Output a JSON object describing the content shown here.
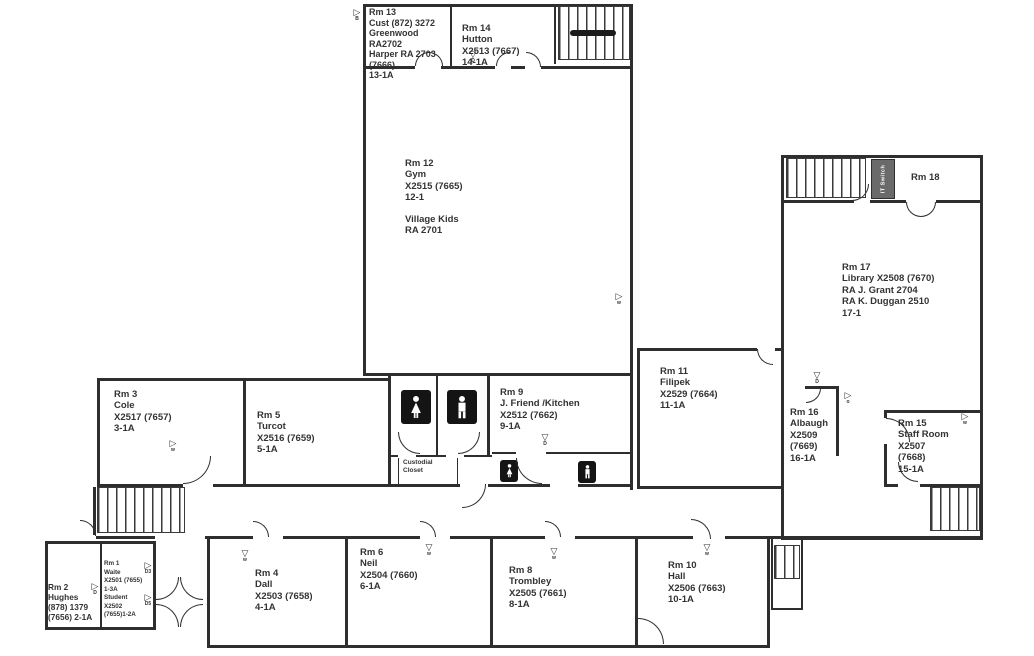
{
  "rooms": {
    "rm13": {
      "lines": [
        "Rm 13",
        "Cust (872) 3272",
        "Greenwood",
        "RA2702",
        "Harper RA 2703",
        "(7666)",
        "13-1A"
      ]
    },
    "rm14": {
      "lines": [
        "Rm 14",
        "Hutton",
        "X2513 (7667)",
        "14-1A"
      ]
    },
    "rm12": {
      "lines": [
        "Rm 12",
        "Gym",
        "X2515 (7665)",
        "12-1",
        "",
        "Village Kids",
        "RA 2701"
      ]
    },
    "rm18": {
      "lines": [
        "Rm 18"
      ]
    },
    "rm17": {
      "lines": [
        "Rm 17",
        "Library X2508 (7670)",
        "RA J. Grant 2704",
        "RA K. Duggan 2510",
        "17-1"
      ]
    },
    "rm11": {
      "lines": [
        "Rm 11",
        "Filipek",
        "X2529 (7664)",
        "11-1A"
      ]
    },
    "rm16": {
      "lines": [
        "Rm 16",
        "Albaugh",
        "X2509",
        "(7669)",
        "16-1A"
      ]
    },
    "rm15": {
      "lines": [
        "Rm 15",
        "Staff Room",
        "X2507",
        "(7668)",
        "15-1A"
      ]
    },
    "rm3": {
      "lines": [
        "Rm 3",
        "Cole",
        "X2517 (7657)",
        "3-1A"
      ]
    },
    "rm5": {
      "lines": [
        "Rm 5",
        "Turcot",
        "X2516 (7659)",
        "5-1A"
      ]
    },
    "rm9": {
      "lines": [
        "Rm 9",
        "J. Friend /Kitchen",
        "X2512 (7662)",
        "9-1A"
      ]
    },
    "rm2": {
      "lines": [
        "Rm 2",
        "Hughes",
        "(878) 1379",
        "(7656) 2-1A"
      ]
    },
    "rm1": {
      "lines": [
        "Rm 1",
        "Waite",
        "X2501 (7655)",
        "1-3A",
        "Student",
        "X2502",
        "(7655)1-2A"
      ]
    },
    "rm4": {
      "lines": [
        "Rm 4",
        "Dall",
        "X2503 (7658)",
        "4-1A"
      ]
    },
    "rm6": {
      "lines": [
        "Rm 6",
        "Neil",
        "X2504 (7660)",
        "6-1A"
      ]
    },
    "rm8": {
      "lines": [
        "Rm 8",
        "Trombley",
        "X2505 (7661)",
        "8-1A"
      ]
    },
    "rm10": {
      "lines": [
        "Rm 10",
        "Hall",
        "X2506 (7663)",
        "10-1A"
      ]
    }
  },
  "labels": {
    "custodial": [
      "Custodial",
      "Closet"
    ],
    "it_switch": "IT Switch"
  },
  "markers": [
    {
      "symbol": "▷",
      "label": "B"
    },
    {
      "symbol": "▽",
      "label": "D"
    },
    {
      "symbol": "▷",
      "label": "w"
    },
    {
      "symbol": "▷",
      "label": "w"
    },
    {
      "symbol": "▽",
      "label": "D"
    },
    {
      "symbol": "▷",
      "label": "o"
    },
    {
      "symbol": "▷",
      "label": "w"
    },
    {
      "symbol": "▽",
      "label": "D"
    },
    {
      "symbol": "▷",
      "label": "D"
    },
    {
      "symbol": "▷",
      "label": "D3"
    },
    {
      "symbol": "▷",
      "label": "D5"
    },
    {
      "symbol": "▽",
      "label": "w"
    },
    {
      "symbol": "▽",
      "label": "w"
    },
    {
      "symbol": "▽",
      "label": "w"
    },
    {
      "symbol": "▽",
      "label": "w"
    }
  ]
}
